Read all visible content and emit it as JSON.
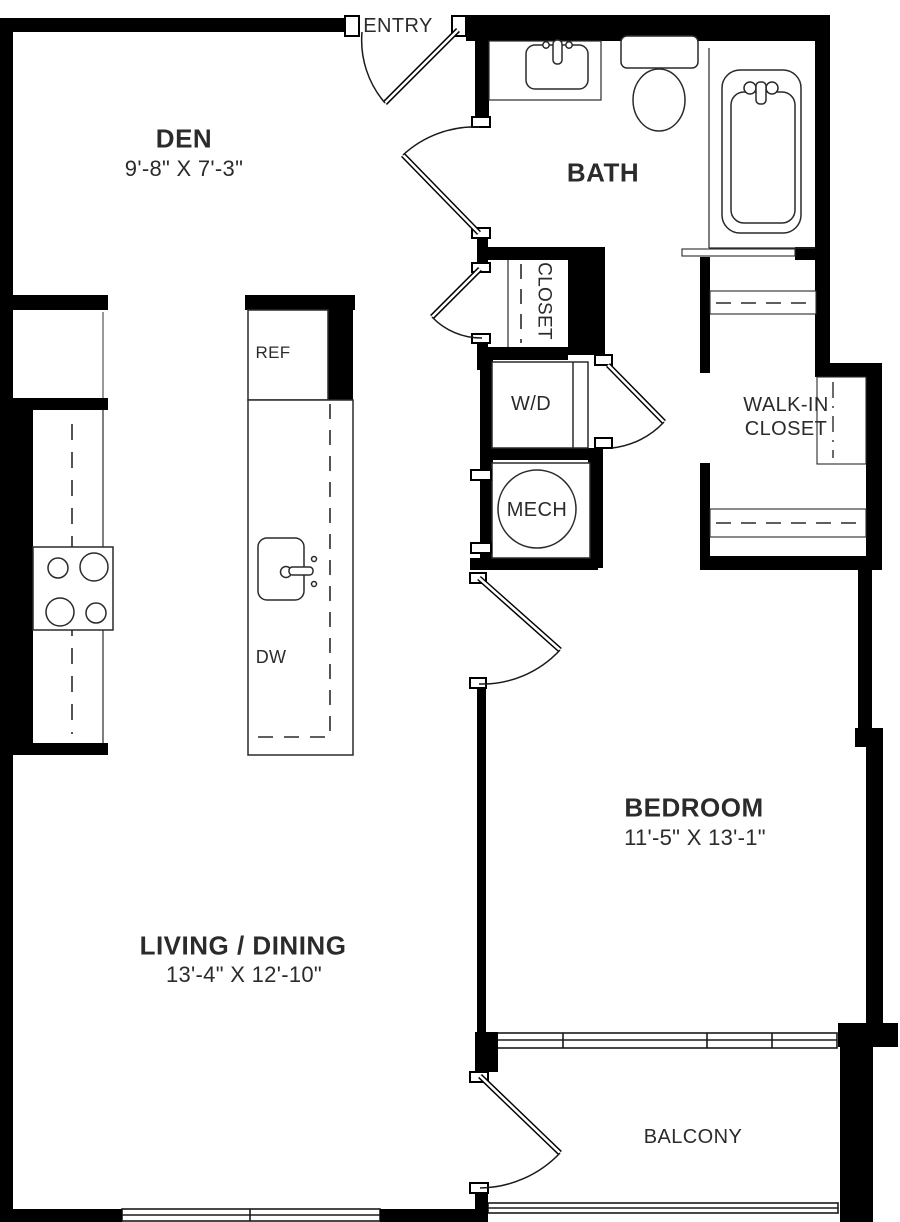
{
  "plan": {
    "rooms": {
      "den": {
        "name": "DEN",
        "dims": "9'-8\" X 7'-3\""
      },
      "entry": {
        "name": "ENTRY"
      },
      "bath": {
        "name": "BATH"
      },
      "hall_closet": {
        "name": "CLOSET"
      },
      "laundry": {
        "name": "W/D"
      },
      "mech": {
        "name": "MECH"
      },
      "walk_in_closet": {
        "name": "WALK-IN CLOSET"
      },
      "bedroom": {
        "name": "BEDROOM",
        "dims": "11'-5\" X 13'-1\""
      },
      "living_dining": {
        "name": "LIVING / DINING",
        "dims": "13'-4\" X 12'-10\""
      },
      "balcony": {
        "name": "BALCONY"
      }
    },
    "appliances": {
      "refrigerator": "REF",
      "dishwasher": "DW"
    },
    "colors": {
      "wall": "#000000",
      "line": "#2a2a2a",
      "text": "#2b2b2b",
      "background": "#ffffff"
    }
  }
}
